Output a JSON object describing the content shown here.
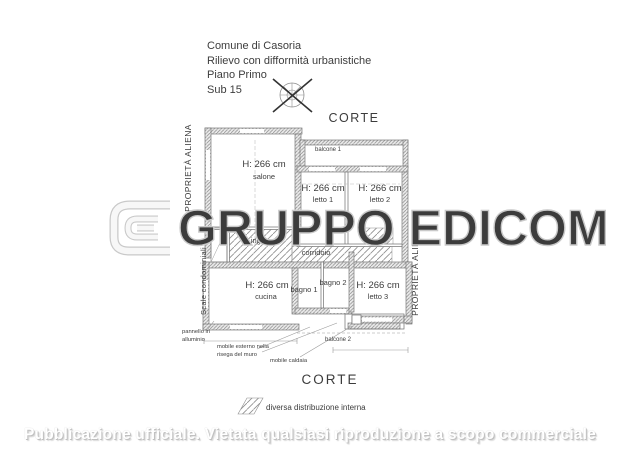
{
  "header": {
    "municipality": "Comune di Casoria",
    "survey": "Rilievo con difformità urbanistiche",
    "floor": "Piano Primo",
    "sub": "Sub 15"
  },
  "plan": {
    "corte_top": "CORTE",
    "corte_bottom": "CORTE",
    "left_property": "PROPRIETÀ ALIENA",
    "right_property": "PROPRIETÀ ALIENA",
    "stairs": "Scale condominiali",
    "rooms": {
      "salone": {
        "h": "H: 266 cm",
        "name": "salone"
      },
      "letto1": {
        "h": "H: 266 cm",
        "name": "letto 1"
      },
      "letto2": {
        "h": "H: 266 cm",
        "name": "letto 2"
      },
      "letto3": {
        "h": "H: 266 cm",
        "name": "letto 3"
      },
      "cucina": {
        "h": "H: 266 cm",
        "name": "cucina"
      },
      "bagno1": {
        "name": "bagno 1"
      },
      "bagno2": {
        "name": "bagno 2"
      },
      "ingresso": {
        "name": "ingresso"
      },
      "corridoio": {
        "name": "corridoio"
      },
      "balcone1": {
        "name": "balcone 1"
      },
      "balcone2": {
        "name": "balcone 2"
      }
    },
    "annotations": {
      "pannello_line1": "pannello in",
      "pannello_line2": "alluminio",
      "mobile_esterno_line1": "mobile esterno nella",
      "mobile_esterno_line2": "risega del muro",
      "mobile_caldaia": "mobile caldaia"
    }
  },
  "legend": {
    "label": "diversa distribuzione interna"
  },
  "watermark": {
    "text": "GRUPPO EDICOM"
  },
  "footer": {
    "text": "Pubblicazione ufficiale. Vietata qualsiasi riproduzione a scopo commerciale"
  },
  "colors": {
    "plan_line": "#707070",
    "wall_fill": "#eaeaea",
    "hatch_line": "#8d8d8d",
    "text": "#3c3c3c",
    "watermark_fill": "#ffffff",
    "watermark_stroke": "#c9c9c9",
    "footer_shadow": "#c0c0c0"
  }
}
